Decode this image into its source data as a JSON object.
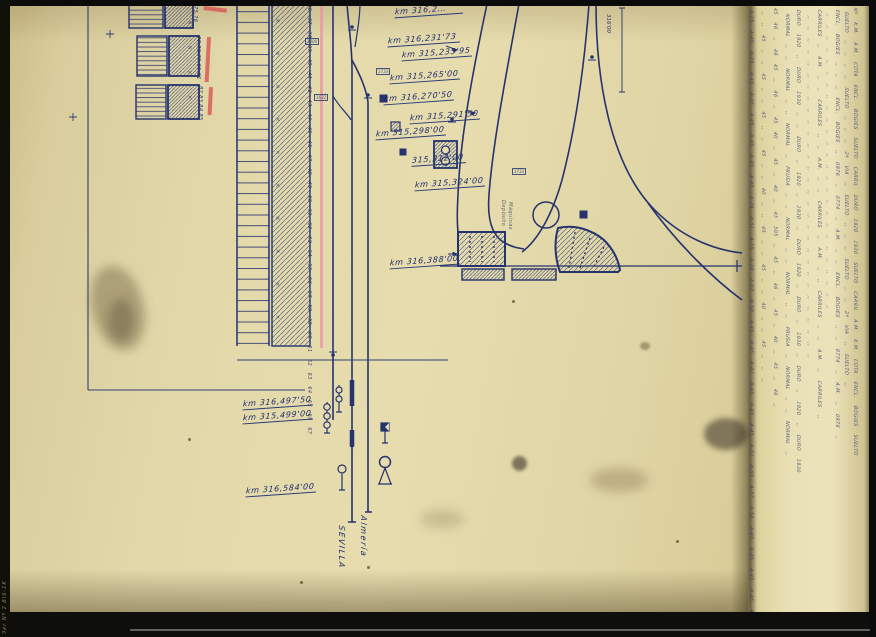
{
  "labels": {
    "km": [
      "km 316,2…",
      "km 316,231'73",
      "km 315,235'95",
      "km 315,265'00",
      "km 316,270'50",
      "km 315,291'50",
      "km 315,298'00",
      "315,312'00",
      "km 315,324'00",
      "km 316,388'00",
      "km 316,497'50",
      "km 315,499'00",
      "km 316,584'00"
    ],
    "direction_left": "SEVILLA",
    "direction_right": "Almería",
    "measure": "316'00",
    "depot_1": "Depósito",
    "depot_2": "Máquinas",
    "corner_note": "3er Nº 2 BIS-1K"
  },
  "numbers": {
    "buildings": [
      "75,76",
      "77,78,79,80,81",
      "82,83,84,85"
    ],
    "strip": "36 37 38 39 40 41 42 43 44 45 46 47 48 49 50 51 52 53 54 55 56 57 58 59 60 61 62 63 64 65 66 67",
    "boxed": [
      "1300",
      "1733",
      "1622",
      "1733"
    ]
  },
  "table": {
    "lines": [
      "A-25 A-45 A-45 A-45 A-45 A-45 A-45 A-45 A-45 A-29 A-51 A-55 A-38 A-57 A-58 A-45 A-45 A-41 A-45 A-45 A-45 A-51 A-55 A-57 A-58 A-45 A-45 A-45 A-45 A-45",
      ",, ,, 45 ,, ,, 45 ,, ,, 45 ,, ,, 45 ,, ,, 40 ,, ,, 45 ,, ,, 45 ,, ,, 40 ,, ,, 45 ,, ,, ,,",
      "45 46 ,, 46 45 ,, 46 ,, 45 40 ,, 45 ,, 40 ,, 45 505 ,, 45 ,, 46 ,, 45 ,, 40 ,, 45 ,, 46 ,,",
      "NORMAL ,, ,, NORMAL ,, ,, NORMAL ,, PRUSIA ,, ,, NORMAL ,, ,, NORMAL ,, ,, PRUSIA ,, NORMAL ,, ,, NORMAL ,,",
      "DURO 1920 ,, DURO 1930 ,, ,, DURO ,, 1920 ,, 1930 ,, DURO 1920 ,, DURO ,, 1930 ,, DURO ,, 1920 ,, DURO 1930",
      ",, ,, ,, ,, ,, ,, ,, ,, ,, ,, ,, ,, ,, ,, ,, ,, ,, ,, ,, ,, ,, ,, ,, ,, ,, ,, ,, ,, ,, ,,",
      "CARRILES ,, A.M. ,, ,, CARRILES ,, ,, A.M. ,, ,, CARRILES ,, A.M. ,, ,, CARRILES ,, ,, A.M. ,, CARRILES ,,",
      ",, ,, ,, ,, ,, ,, ,, ,, ,, ,, ,, ,, ,, ,, ,, ,, ,, ,, ,, ,, ,, ,, ,, ,, ,, ,,",
      "ENCL. BOGIES ,, ,, ,, ENCL. BOGIES ,, 0976 ,, 0774 ,, A.M. ,, ,, ENCL. BOGIES ,, ,, 0774 ,, A.M. ,, 0976 ,,",
      "SUELTO ,, ,, ,, ,, SUELTO ,, ,, ,, 2ª VIA ,, SUELTO ,, ,, ,, SUELTO ,, ,, 2ª VIA ,, SUELTO ,,",
      "Nº K.M. A.M. COTA ENCL. BOGIES SUELTO CARRIL DURO 1920 1930 SUELTO CARRIL A.M. K.M. COTA ENCL. BOGIES SUELTO"
    ]
  },
  "decor": {
    "strip_crosses": "× × × × × × × × × ×",
    "yard_crosses": "× × × ×"
  },
  "colors": {
    "ink": "#25336e",
    "red_mark": "#d95555",
    "pink_line": "#eb9aa2",
    "paper": "#e3d9ac"
  }
}
